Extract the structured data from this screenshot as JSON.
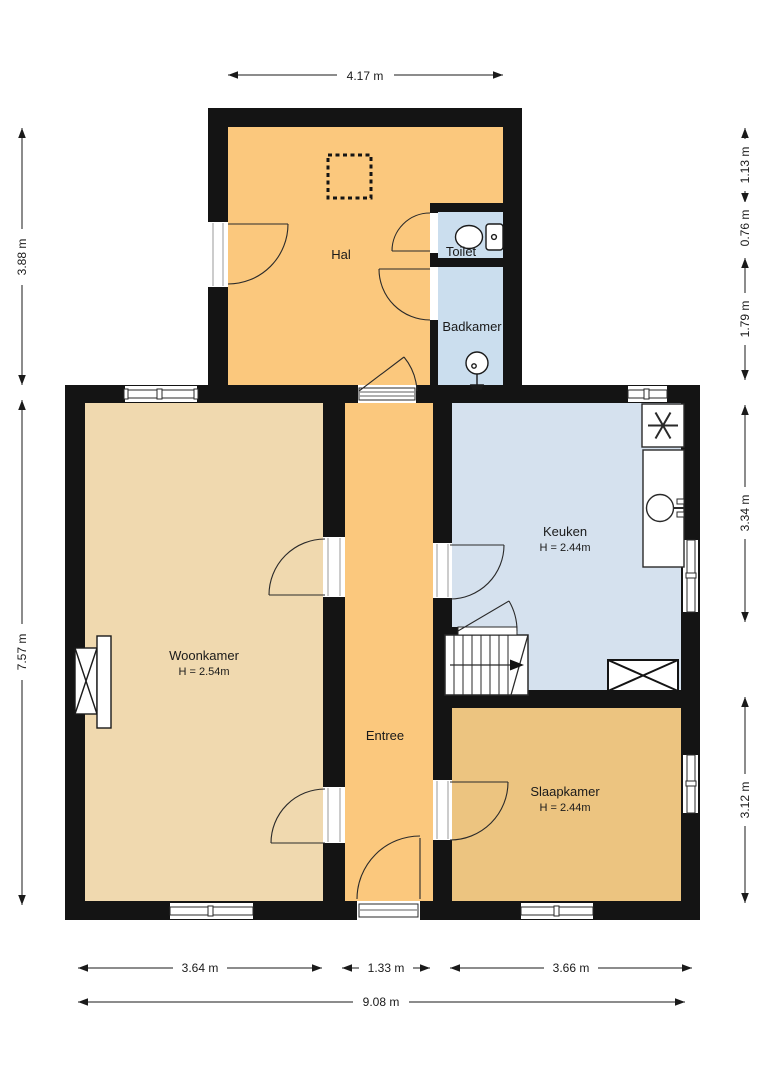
{
  "rooms": {
    "hal": {
      "label": "Hal"
    },
    "toilet": {
      "label": "Toilet"
    },
    "badkamer": {
      "label": "Badkamer"
    },
    "keuken": {
      "label": "Keuken",
      "height": "H = 2.44m"
    },
    "woonkamer": {
      "label": "Woonkamer",
      "height": "H = 2.54m"
    },
    "entree": {
      "label": "Entree"
    },
    "slaapkamer": {
      "label": "Slaapkamer",
      "height": "H = 2.44m"
    }
  },
  "dimensions": {
    "top": "4.17 m",
    "left_upper": "3.88 m",
    "left_lower": "7.57 m",
    "right_1": "1.13 m",
    "right_2": "0.76 m",
    "right_3": "1.79 m",
    "right_4": "3.34 m",
    "right_5": "3.12 m",
    "bottom_1": "3.64 m",
    "bottom_2": "1.33 m",
    "bottom_3": "3.66 m",
    "bottom_total": "9.08 m"
  },
  "colors": {
    "wall": "#141414",
    "hal": "#fbc87d",
    "entree": "#fbc87d",
    "woonkamer": "#f0d9af",
    "slaapkamer": "#ecc480",
    "keuken": "#d5e1ee",
    "toilet": "#cbdeee",
    "badkamer": "#cbdeee",
    "line": "#2a2a2a"
  }
}
